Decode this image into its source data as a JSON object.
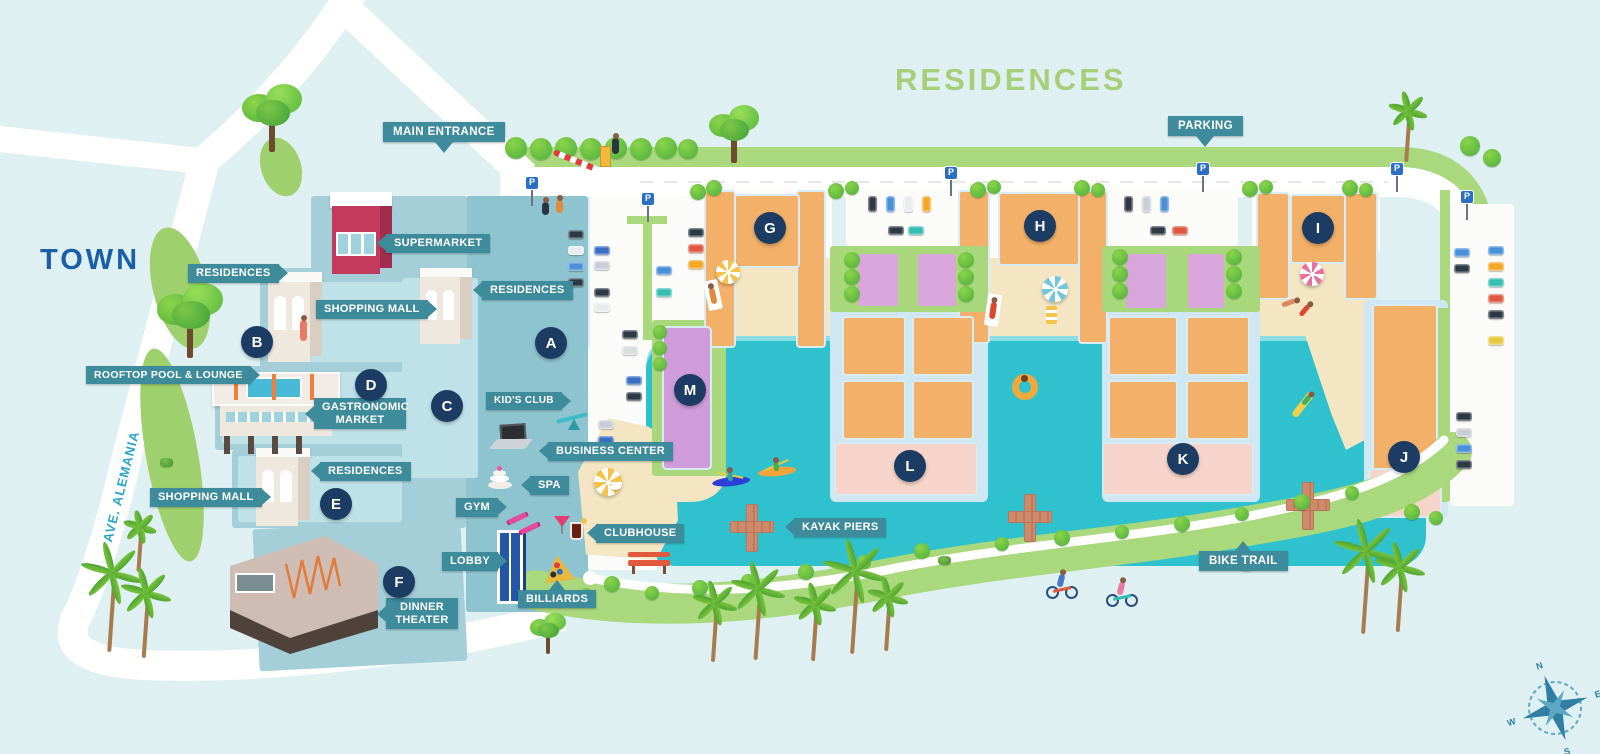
{
  "map": {
    "title": "RESIDENCES",
    "town": "TOWN",
    "street": "AVE. ALEMANIA",
    "parking_sign": "P",
    "compass": {
      "n": "N",
      "e": "E",
      "s": "S",
      "w": "W"
    },
    "flags": {
      "main_entrance": "MAIN ENTRANCE",
      "parking": "PARKING",
      "bike_trail": "BIKE TRAIL"
    },
    "labels": {
      "supermarket": "SUPERMARKET",
      "residences_b": "RESIDENCES",
      "shopping_mall_b": "SHOPPING MALL",
      "residences_c": "RESIDENCES",
      "rooftop_pool_lounge": "ROOFTOP POOL & LOUNGE",
      "gastronomic_market": "GASTRONOMIC MARKET",
      "residences_e": "RESIDENCES",
      "shopping_mall_e": "SHOPPING MALL",
      "kids_club": "KID'S CLUB",
      "business_center": "BUSINESS CENTER",
      "spa": "SPA",
      "gym": "GYM",
      "clubhouse": "CLUBHOUSE",
      "lobby": "LOBBY",
      "billiards": "BILLIARDS",
      "dinner_theater": "DINNER THEATER",
      "kayak_piers": "KAYAK PIERS"
    },
    "markers": {
      "a": "A",
      "b": "B",
      "c": "C",
      "d": "D",
      "e": "E",
      "f": "F",
      "g": "G",
      "h": "H",
      "i": "I",
      "j": "J",
      "k": "K",
      "l": "L",
      "m": "M"
    }
  },
  "colors": {
    "label_teal": "#3E8B9C",
    "marker_navy": "#1D3C63",
    "water": "#2FC2CE",
    "sand": "#F4E6C3",
    "lawn_green": "#A8D87B",
    "building_orange": "#F2B068",
    "building_pink": "#F7D4C9",
    "pool_deck_purple": "#D9A6DC",
    "resort_teal": "#A4CED8",
    "title_green": "#A7CF7A",
    "town_blue": "#1B5FA8",
    "street_cyan": "#2BA6C9",
    "road_green": "#A9D87D",
    "supermarket_red": "#C23A5E"
  }
}
